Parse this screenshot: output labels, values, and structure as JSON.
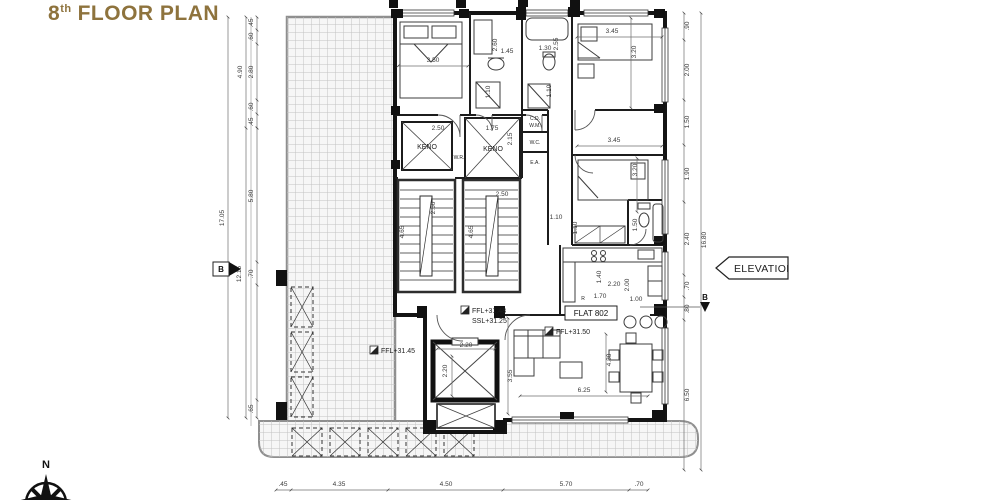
{
  "title": {
    "number": "8",
    "ordinal": "th",
    "label": "FLOOR PLAN"
  },
  "colors": {
    "title_gold": "#8e733d",
    "ink": "#2e2e2e",
    "hatch_line": "#c2c2c2",
    "wall": "#111111"
  },
  "compass": {
    "north_label": "N"
  },
  "elevation_tag": {
    "label": "ELEVATION"
  },
  "section_markers": {
    "left": "B",
    "right": "B"
  },
  "flat": {
    "label": "FLAT 802"
  },
  "levels": {
    "lobby_ffl": "FFL+31.48",
    "lobby_ssl": "SSL+31.25",
    "living_ffl": "FFL+31.50",
    "terrace_ffl": "FFL+31.45"
  },
  "rooms": {
    "shaft_left": "KENO",
    "shaft_right": "KENO",
    "wr": "W.R.",
    "closet_top_line1": "C.D.",
    "closet_top_line2": "W.M.",
    "closet_mid": "W.C.",
    "closet_bottom": "E.A.",
    "kitchen_r": "R"
  },
  "dimensions": {
    "left": [
      ".45",
      ".60",
      "2.80",
      ".60",
      ".45",
      "4.90",
      "17.05",
      "5.80",
      ".70",
      "12.15",
      ".65"
    ],
    "right": [
      ".90",
      "2.00",
      "1.50",
      "1.90",
      "2.40",
      ".70",
      ".80",
      "6.50",
      "16.80"
    ],
    "bottom": [
      ".45",
      "4.35",
      "4.50",
      "5.70",
      ".70"
    ],
    "interior": [
      "3.50",
      "2.60",
      "1.45",
      "1.30",
      "2.55",
      "3.45",
      "3.20",
      "1.10",
      "1.10",
      "2.50",
      "1.75",
      "2.15",
      "2.50",
      "4.65",
      "2.50",
      "4.65",
      "1.10",
      "1.10",
      "1.50",
      "3.45",
      "3.20",
      "1.40",
      "2.20",
      "2.00",
      "1.70",
      "1.00",
      "2.20",
      "2.20",
      "3.55",
      "4.30",
      "6.25"
    ]
  }
}
